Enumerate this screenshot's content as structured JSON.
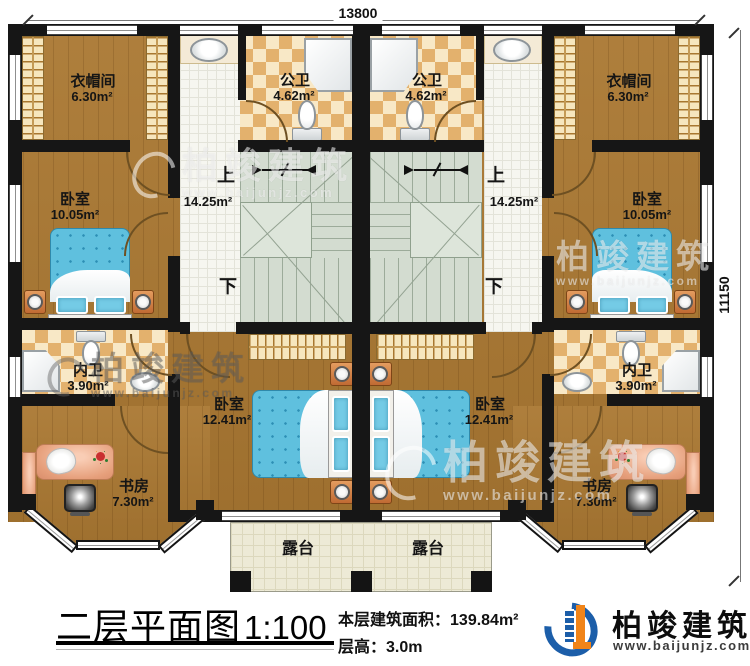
{
  "plan": {
    "dim_top": "13800",
    "dim_right": "11150",
    "rooms": {
      "cloakroom_l": {
        "name": "衣帽间",
        "area": "6.30m²"
      },
      "cloakroom_r": {
        "name": "衣帽间",
        "area": "6.30m²"
      },
      "pubbath_l": {
        "name": "公卫",
        "area": "4.62m²"
      },
      "pubbath_r": {
        "name": "公卫",
        "area": "4.62m²"
      },
      "bedroom_top_l": {
        "name": "卧室",
        "area": "10.05m²"
      },
      "bedroom_top_r": {
        "name": "卧室",
        "area": "10.05m²"
      },
      "hall_l": {
        "up": "上",
        "down": "下",
        "area": "14.25m²"
      },
      "hall_r": {
        "up": "上",
        "down": "下",
        "area": "14.25m²"
      },
      "privbath_l": {
        "name": "内卫",
        "area": "3.90m²"
      },
      "privbath_r": {
        "name": "内卫",
        "area": "3.90m²"
      },
      "bedroom_bot_l": {
        "name": "卧室",
        "area": "12.41m²"
      },
      "bedroom_bot_r": {
        "name": "卧室",
        "area": "12.41m²"
      },
      "study_l": {
        "name": "书房",
        "area": "7.30m²"
      },
      "study_r": {
        "name": "书房",
        "area": "7.30m²"
      },
      "terrace_l": {
        "name": "露台"
      },
      "terrace_r": {
        "name": "露台"
      }
    }
  },
  "legend": {
    "title": "二层平面图",
    "scale": "1:100",
    "area_label": "本层建筑面积：",
    "area_value": "139.84m²",
    "height_label": "层高：",
    "height_value": "3.0m"
  },
  "brand": {
    "name": "柏竣建筑",
    "url": "www.baijunjz.com"
  },
  "watermark": {
    "name": "柏竣建筑",
    "url": "www.baijunjz.com"
  },
  "colors": {
    "wall": "#161616",
    "wood": "#aa7832",
    "tile_check": "#e3b16d",
    "tile_white": "#f6f6f0",
    "stair": "#d3dcd0",
    "terrace": "#edead6",
    "bed_blue": "#5fc0de",
    "nightstand_orange": "#c06a33",
    "desk_salmon": "#e69f7b",
    "logo_blue": "#1c5ea9",
    "logo_orange": "#f08419"
  }
}
